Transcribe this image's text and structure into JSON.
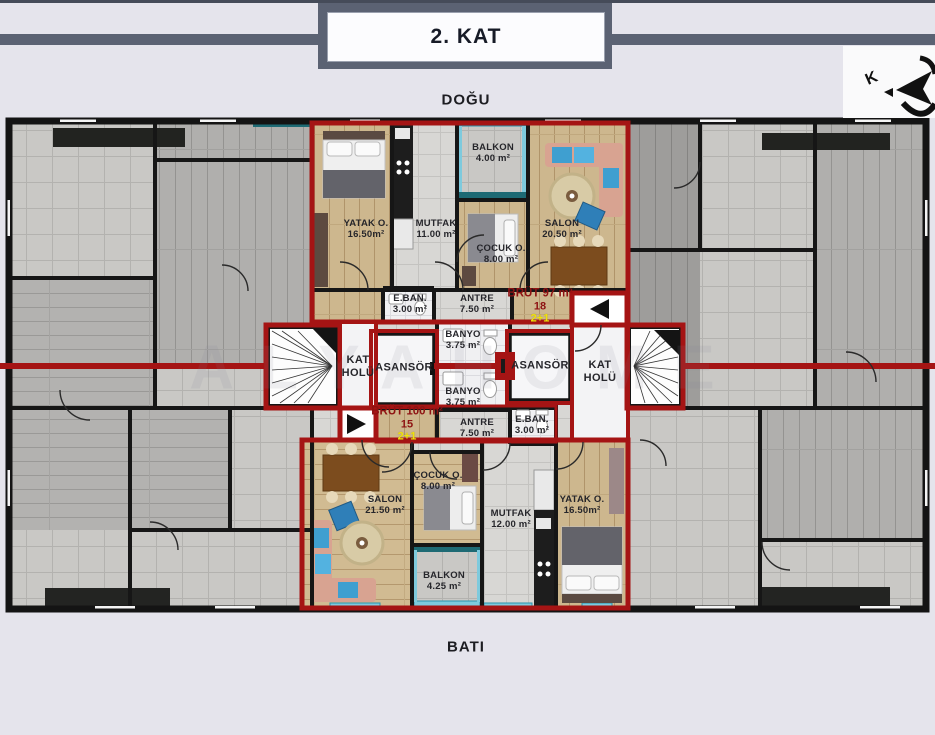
{
  "page": {
    "title": "2. KAT",
    "top_label": "DOĞU",
    "bottom_label": "BATI",
    "compass_letter": "K",
    "watermark": "ALYAHOME"
  },
  "core": {
    "kat_holu_left": {
      "line1": "KAT",
      "line2": "HOLÜ"
    },
    "kat_holu_right": {
      "line1": "KAT",
      "line2": "HOLÜ"
    },
    "asansor_left": "ASANSÖR",
    "asansor_right": "ASANSÖR",
    "banyo_upper": {
      "name": "BANYO",
      "area": "3.75 m²"
    },
    "banyo_lower": {
      "name": "BANYO",
      "area": "3.75 m²"
    }
  },
  "apartment_top": {
    "unit": {
      "gross": "BRÜT 97 m²",
      "no": "18",
      "type": "2+1"
    },
    "rooms": {
      "yatak": {
        "name": "YATAK O.",
        "area": "16.50m²"
      },
      "mutfak": {
        "name": "MUTFAK",
        "area": "11.00 m²"
      },
      "balkon": {
        "name": "BALKON",
        "area": "4.00 m²"
      },
      "cocuk": {
        "name": "ÇOCUK O.",
        "area": "8.00 m²"
      },
      "salon": {
        "name": "SALON",
        "area": "20.50 m²"
      },
      "eban": {
        "name": "E.BAN.",
        "area": "3.00 m²"
      },
      "antre": {
        "name": "ANTRE",
        "area": "7.50 m²"
      }
    }
  },
  "apartment_bottom": {
    "unit": {
      "gross": "BRÜT 100 m²",
      "no": "15",
      "type": "2+1"
    },
    "rooms": {
      "salon": {
        "name": "SALON",
        "area": "21.50 m²"
      },
      "cocuk": {
        "name": "ÇOCUK O.",
        "area": "8.00 m²"
      },
      "balkon": {
        "name": "BALKON",
        "area": "4.25 m²"
      },
      "mutfak": {
        "name": "MUTFAK",
        "area": "12.00 m²"
      },
      "yatak": {
        "name": "YATAK O.",
        "area": "16.50m²"
      },
      "eban": {
        "name": "E.BAN.",
        "area": "3.00 m²"
      },
      "antre": {
        "name": "ANTRE",
        "area": "7.50 m²"
      }
    }
  }
}
